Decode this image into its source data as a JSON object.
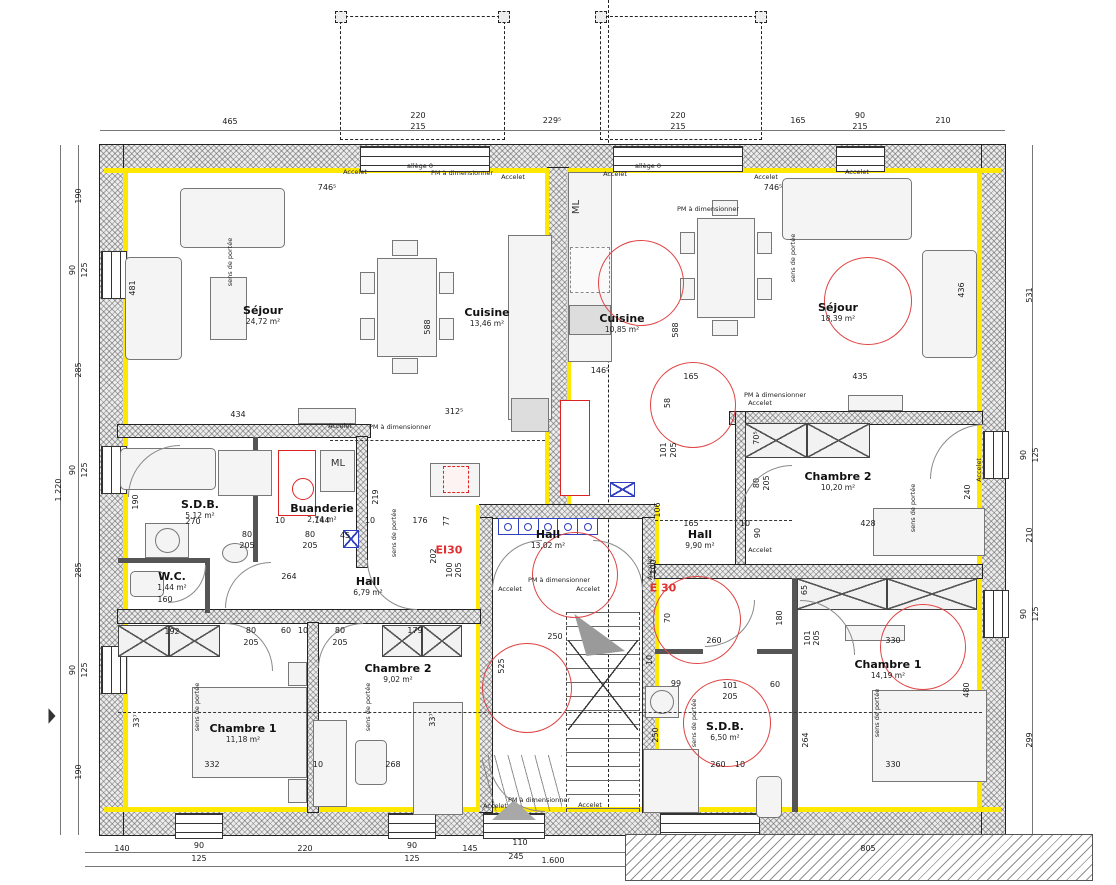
{
  "colors": {
    "insulation": "#ffe800",
    "fire": "#e03030",
    "circle": "#e04343",
    "blue": "#2f3fbf"
  },
  "annotations": {
    "pm": "PM à dimensionner",
    "accelet": "Accelet",
    "sens": "sens de portée",
    "ml": "ML",
    "ei30": "EI30",
    "e30": "E 30",
    "allege": "allège 0"
  },
  "rooms": [
    {
      "name": "Séjour",
      "area": "24,72 m²",
      "x": 263,
      "y": 315
    },
    {
      "name": "Cuisine",
      "area": "13,46 m²",
      "x": 487,
      "y": 317
    },
    {
      "name": "Cuisine",
      "area": "10,85 m²",
      "x": 622,
      "y": 323
    },
    {
      "name": "Séjour",
      "area": "18,39 m²",
      "x": 838,
      "y": 312
    },
    {
      "name": "S.D.B.",
      "area": "5,12 m²",
      "x": 200,
      "y": 509
    },
    {
      "name": "Buanderie",
      "area": "2,74 m²",
      "x": 322,
      "y": 513
    },
    {
      "name": "W.C.",
      "area": "1,44 m²",
      "x": 172,
      "y": 581
    },
    {
      "name": "Hall",
      "area": "6,79 m²",
      "x": 368,
      "y": 586
    },
    {
      "name": "Hall",
      "area": "13,02 m²",
      "x": 548,
      "y": 539
    },
    {
      "name": "Hall",
      "area": "9,90 m²",
      "x": 700,
      "y": 539
    },
    {
      "name": "Chambre 2",
      "area": "10,20 m²",
      "x": 838,
      "y": 481
    },
    {
      "name": "Chambre 2",
      "area": "9,02 m²",
      "x": 398,
      "y": 673
    },
    {
      "name": "Chambre 1",
      "area": "11,18 m²",
      "x": 243,
      "y": 733
    },
    {
      "name": "Chambre 1",
      "area": "14,19 m²",
      "x": 888,
      "y": 669
    },
    {
      "name": "S.D.B.",
      "area": "6,50 m²",
      "x": 725,
      "y": 731
    }
  ],
  "red_circles": [
    {
      "x": 641,
      "y": 283,
      "d": 86
    },
    {
      "x": 868,
      "y": 301,
      "d": 88
    },
    {
      "x": 693,
      "y": 405,
      "d": 86
    },
    {
      "x": 575,
      "y": 575,
      "d": 86
    },
    {
      "x": 527,
      "y": 688,
      "d": 90
    },
    {
      "x": 697,
      "y": 620,
      "d": 88
    },
    {
      "x": 727,
      "y": 723,
      "d": 88
    },
    {
      "x": 923,
      "y": 647,
      "d": 86
    }
  ],
  "dims": [
    {
      "t": "465",
      "x": 230,
      "y": 122
    },
    {
      "t": "220",
      "x": 418,
      "y": 116
    },
    {
      "t": "215",
      "x": 418,
      "y": 127
    },
    {
      "t": "229⁵",
      "x": 552,
      "y": 121
    },
    {
      "t": "220",
      "x": 678,
      "y": 116
    },
    {
      "t": "215",
      "x": 678,
      "y": 127
    },
    {
      "t": "165",
      "x": 798,
      "y": 121
    },
    {
      "t": "90",
      "x": 860,
      "y": 116
    },
    {
      "t": "215",
      "x": 860,
      "y": 127
    },
    {
      "t": "210",
      "x": 943,
      "y": 121
    },
    {
      "t": "140",
      "x": 122,
      "y": 849
    },
    {
      "t": "90",
      "x": 199,
      "y": 846
    },
    {
      "t": "125",
      "x": 199,
      "y": 859
    },
    {
      "t": "220",
      "x": 305,
      "y": 849
    },
    {
      "t": "90",
      "x": 412,
      "y": 846
    },
    {
      "t": "125",
      "x": 412,
      "y": 859
    },
    {
      "t": "145",
      "x": 470,
      "y": 849
    },
    {
      "t": "110",
      "x": 520,
      "y": 843
    },
    {
      "t": "245",
      "x": 516,
      "y": 857
    },
    {
      "t": "1.600",
      "x": 553,
      "y": 861
    },
    {
      "t": "805",
      "x": 868,
      "y": 849
    },
    {
      "t": "190",
      "x": 79,
      "y": 196,
      "r": 1
    },
    {
      "t": "90",
      "x": 73,
      "y": 270,
      "r": 1
    },
    {
      "t": "125",
      "x": 85,
      "y": 270,
      "r": 1
    },
    {
      "t": "285",
      "x": 79,
      "y": 370,
      "r": 1
    },
    {
      "t": "90",
      "x": 73,
      "y": 470,
      "r": 1
    },
    {
      "t": "125",
      "x": 85,
      "y": 470,
      "r": 1
    },
    {
      "t": "285",
      "x": 79,
      "y": 570,
      "r": 1
    },
    {
      "t": "90",
      "x": 73,
      "y": 670,
      "r": 1
    },
    {
      "t": "125",
      "x": 85,
      "y": 670,
      "r": 1
    },
    {
      "t": "190",
      "x": 79,
      "y": 772,
      "r": 1
    },
    {
      "t": "1.220",
      "x": 59,
      "y": 490,
      "r": 1
    },
    {
      "t": "531",
      "x": 1030,
      "y": 295,
      "r": 1
    },
    {
      "t": "90",
      "x": 1024,
      "y": 455,
      "r": 1
    },
    {
      "t": "125",
      "x": 1036,
      "y": 455,
      "r": 1
    },
    {
      "t": "210",
      "x": 1030,
      "y": 535,
      "r": 1
    },
    {
      "t": "90",
      "x": 1024,
      "y": 614,
      "r": 1
    },
    {
      "t": "125",
      "x": 1036,
      "y": 614,
      "r": 1
    },
    {
      "t": "299",
      "x": 1030,
      "y": 740,
      "r": 1
    },
    {
      "t": "746⁵",
      "x": 327,
      "y": 188
    },
    {
      "t": "746⁵",
      "x": 773,
      "y": 188
    },
    {
      "t": "481",
      "x": 133,
      "y": 288,
      "r": 1
    },
    {
      "t": "588",
      "x": 428,
      "y": 327,
      "r": 1
    },
    {
      "t": "588",
      "x": 676,
      "y": 330,
      "r": 1
    },
    {
      "t": "436",
      "x": 962,
      "y": 290,
      "r": 1
    },
    {
      "t": "434",
      "x": 238,
      "y": 415
    },
    {
      "t": "312⁵",
      "x": 454,
      "y": 412
    },
    {
      "t": "146⁵",
      "x": 600,
      "y": 371
    },
    {
      "t": "165",
      "x": 691,
      "y": 377
    },
    {
      "t": "435",
      "x": 860,
      "y": 377
    },
    {
      "t": "58",
      "x": 668,
      "y": 403,
      "r": 1
    },
    {
      "t": "190",
      "x": 136,
      "y": 502,
      "r": 1
    },
    {
      "t": "270",
      "x": 193,
      "y": 522
    },
    {
      "t": "10",
      "x": 280,
      "y": 521
    },
    {
      "t": "144",
      "x": 322,
      "y": 521
    },
    {
      "t": "10",
      "x": 370,
      "y": 521
    },
    {
      "t": "176",
      "x": 420,
      "y": 521
    },
    {
      "t": "77",
      "x": 447,
      "y": 521,
      "r": 1
    },
    {
      "t": "80",
      "x": 247,
      "y": 535
    },
    {
      "t": "205",
      "x": 247,
      "y": 546
    },
    {
      "t": "80",
      "x": 310,
      "y": 535
    },
    {
      "t": "205",
      "x": 310,
      "y": 546
    },
    {
      "t": "45",
      "x": 345,
      "y": 536
    },
    {
      "t": "219",
      "x": 376,
      "y": 497,
      "r": 1
    },
    {
      "t": "264",
      "x": 289,
      "y": 577
    },
    {
      "t": "160",
      "x": 165,
      "y": 600
    },
    {
      "t": "202",
      "x": 434,
      "y": 556,
      "r": 1
    },
    {
      "t": "100",
      "x": 450,
      "y": 570,
      "r": 1
    },
    {
      "t": "205",
      "x": 459,
      "y": 570,
      "r": 1
    },
    {
      "t": "101",
      "x": 664,
      "y": 450,
      "r": 1
    },
    {
      "t": "205",
      "x": 674,
      "y": 450,
      "r": 1
    },
    {
      "t": "106",
      "x": 658,
      "y": 510,
      "r": 1
    },
    {
      "t": "70⁵",
      "x": 757,
      "y": 438,
      "r": 1
    },
    {
      "t": "80",
      "x": 757,
      "y": 483,
      "r": 1
    },
    {
      "t": "205",
      "x": 767,
      "y": 483,
      "r": 1
    },
    {
      "t": "90",
      "x": 758,
      "y": 533,
      "r": 1
    },
    {
      "t": "165",
      "x": 691,
      "y": 524
    },
    {
      "t": "10",
      "x": 745,
      "y": 524
    },
    {
      "t": "428",
      "x": 868,
      "y": 524
    },
    {
      "t": "240",
      "x": 968,
      "y": 492,
      "r": 1
    },
    {
      "t": "65",
      "x": 805,
      "y": 590,
      "r": 1
    },
    {
      "t": "250",
      "x": 555,
      "y": 637
    },
    {
      "t": "525",
      "x": 502,
      "y": 666,
      "r": 1
    },
    {
      "t": "70",
      "x": 668,
      "y": 618,
      "r": 1
    },
    {
      "t": "100",
      "x": 654,
      "y": 567,
      "r": 1
    },
    {
      "t": "192",
      "x": 172,
      "y": 632
    },
    {
      "t": "80",
      "x": 251,
      "y": 631
    },
    {
      "t": "205",
      "x": 251,
      "y": 643
    },
    {
      "t": "60",
      "x": 286,
      "y": 631
    },
    {
      "t": "10",
      "x": 303,
      "y": 631
    },
    {
      "t": "80",
      "x": 340,
      "y": 631
    },
    {
      "t": "205",
      "x": 340,
      "y": 643
    },
    {
      "t": "179",
      "x": 415,
      "y": 631
    },
    {
      "t": "33⁷",
      "x": 137,
      "y": 721,
      "r": 1
    },
    {
      "t": "33⁷",
      "x": 433,
      "y": 720,
      "r": 1
    },
    {
      "t": "332",
      "x": 212,
      "y": 765
    },
    {
      "t": "10",
      "x": 318,
      "y": 765
    },
    {
      "t": "268",
      "x": 393,
      "y": 765
    },
    {
      "t": "260",
      "x": 714,
      "y": 641
    },
    {
      "t": "180",
      "x": 780,
      "y": 618,
      "r": 1
    },
    {
      "t": "101",
      "x": 808,
      "y": 638,
      "r": 1
    },
    {
      "t": "205",
      "x": 817,
      "y": 638,
      "r": 1
    },
    {
      "t": "330",
      "x": 893,
      "y": 641
    },
    {
      "t": "10",
      "x": 650,
      "y": 660,
      "r": 1
    },
    {
      "t": "99",
      "x": 676,
      "y": 684
    },
    {
      "t": "101",
      "x": 730,
      "y": 686
    },
    {
      "t": "205",
      "x": 730,
      "y": 697
    },
    {
      "t": "60",
      "x": 775,
      "y": 685
    },
    {
      "t": "250",
      "x": 656,
      "y": 735,
      "r": 1
    },
    {
      "t": "264",
      "x": 806,
      "y": 740,
      "r": 1
    },
    {
      "t": "480",
      "x": 967,
      "y": 690,
      "r": 1
    },
    {
      "t": "260",
      "x": 718,
      "y": 765
    },
    {
      "t": "330",
      "x": 893,
      "y": 765
    },
    {
      "t": "10",
      "x": 740,
      "y": 765
    }
  ],
  "notes": [
    {
      "k": "accelet",
      "x": 355,
      "y": 172
    },
    {
      "k": "pm",
      "x": 462,
      "y": 173
    },
    {
      "k": "accelet",
      "x": 513,
      "y": 177
    },
    {
      "k": "accelet",
      "x": 615,
      "y": 174
    },
    {
      "k": "accelet",
      "x": 766,
      "y": 177
    },
    {
      "k": "accelet",
      "x": 857,
      "y": 172
    },
    {
      "k": "allege",
      "x": 420,
      "y": 166
    },
    {
      "k": "allege",
      "x": 648,
      "y": 166
    },
    {
      "k": "pm",
      "x": 708,
      "y": 209
    },
    {
      "k": "accelet",
      "x": 340,
      "y": 426
    },
    {
      "k": "pm",
      "x": 400,
      "y": 427
    },
    {
      "k": "pm",
      "x": 775,
      "y": 395
    },
    {
      "k": "accelet",
      "x": 760,
      "y": 403
    },
    {
      "k": "accelet",
      "x": 760,
      "y": 550
    },
    {
      "k": "pm",
      "x": 559,
      "y": 580
    },
    {
      "k": "accelet",
      "x": 510,
      "y": 589
    },
    {
      "k": "accelet",
      "x": 588,
      "y": 589
    },
    {
      "k": "accelet",
      "x": 650,
      "y": 568,
      "r": 1
    },
    {
      "k": "accelet",
      "x": 979,
      "y": 470,
      "r": 1
    },
    {
      "k": "pm",
      "x": 539,
      "y": 800
    },
    {
      "k": "accelet",
      "x": 495,
      "y": 806
    },
    {
      "k": "accelet",
      "x": 590,
      "y": 805
    },
    {
      "k": "sens",
      "x": 230,
      "y": 262,
      "r": 1
    },
    {
      "k": "sens",
      "x": 793,
      "y": 258,
      "r": 1
    },
    {
      "k": "sens",
      "x": 913,
      "y": 508,
      "r": 1
    },
    {
      "k": "sens",
      "x": 877,
      "y": 713,
      "r": 1
    },
    {
      "k": "sens",
      "x": 694,
      "y": 723,
      "r": 1
    },
    {
      "k": "sens",
      "x": 394,
      "y": 533,
      "r": 1
    },
    {
      "k": "sens",
      "x": 197,
      "y": 707,
      "r": 1
    },
    {
      "k": "sens",
      "x": 368,
      "y": 707,
      "r": 1
    },
    {
      "k": "ml",
      "x": 577,
      "y": 207,
      "r": 1,
      "big": 1
    },
    {
      "k": "ml",
      "x": 338,
      "y": 464,
      "big": 1
    },
    {
      "k": "ei30",
      "x": 449,
      "y": 550,
      "red": 1
    },
    {
      "k": "e30",
      "x": 663,
      "y": 588,
      "red": 1
    }
  ]
}
